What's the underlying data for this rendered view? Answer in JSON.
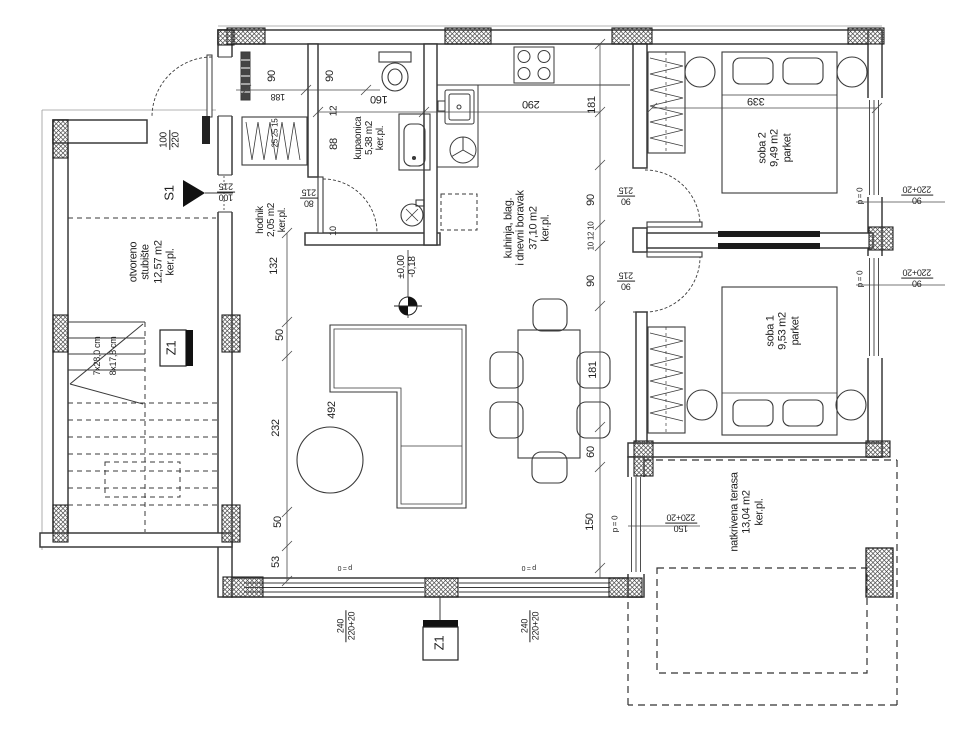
{
  "palette": {
    "line": "#3a3a3a",
    "wall_fill": "#ffffff",
    "hatch": "#4a4a4a",
    "solid_black": "#1c1c1c",
    "text": "#1f1f1f",
    "bg": "#ffffff"
  },
  "rooms_summary": [
    {
      "name": "otvoreno stubište",
      "area": "12,57 m2",
      "floor": "ker.pl."
    },
    {
      "name": "hodnik",
      "area": "2,05 m2",
      "floor": "ker.pl."
    },
    {
      "name": "kupaonica",
      "area": "5,38 m2",
      "floor": "ker.pl."
    },
    {
      "name": "kuhinja, blag. i dnevni boravak",
      "area": "37,10 m2",
      "floor": "ker.pl."
    },
    {
      "name": "soba 1",
      "area": "9,53 m2",
      "floor": "parket"
    },
    {
      "name": "soba 2",
      "area": "9,49 m2",
      "floor": "parket"
    },
    {
      "name": "natkrivena terasa",
      "area": "13,04 m2",
      "floor": "ker.pl."
    }
  ],
  "room_labels": [
    {
      "name": "room-label-stubiste",
      "lines": [
        "otvoreno",
        "stubište",
        "12,57 m2",
        "ker.pl."
      ],
      "x": 152,
      "y": 262,
      "rot": -90,
      "size": 11
    },
    {
      "name": "room-label-hodnik",
      "lines": [
        "hodnik",
        "2,05 m2",
        "ker.pl."
      ],
      "x": 272,
      "y": 220,
      "rot": -90,
      "size": 10
    },
    {
      "name": "room-label-kupaonica",
      "lines": [
        "kupaonica",
        "5,38 m2",
        "ker.pl."
      ],
      "x": 370,
      "y": 138,
      "rot": -90,
      "size": 10
    },
    {
      "name": "room-label-kuhinja",
      "lines": [
        "kuhinja, blag.",
        "i dnevni boravak",
        "37,10 m2",
        "ker.pl."
      ],
      "x": 527,
      "y": 228,
      "rot": -90,
      "size": 11
    },
    {
      "name": "room-label-soba2",
      "lines": [
        "soba 2",
        "9,49 m2",
        "parket"
      ],
      "x": 775,
      "y": 148,
      "rot": -90,
      "size": 11
    },
    {
      "name": "room-label-soba1",
      "lines": [
        "soba 1",
        "9,53 m2",
        "parket"
      ],
      "x": 783,
      "y": 331,
      "rot": -90,
      "size": 11
    },
    {
      "name": "room-label-terasa",
      "lines": [
        "natkrivena terasa",
        "13,04 m2",
        "ker.pl."
      ],
      "x": 747,
      "y": 512,
      "rot": -90,
      "size": 11
    }
  ],
  "dimension_labels": [
    {
      "name": "dim-90-closet-a",
      "lines": [
        "90"
      ],
      "x": 272,
      "y": 76,
      "rot": -90,
      "size": 11
    },
    {
      "name": "dim-90-closet-b",
      "lines": [
        "90"
      ],
      "x": 330,
      "y": 76,
      "rot": -90,
      "size": 11
    },
    {
      "name": "dim-188",
      "lines": [
        "188"
      ],
      "x": 278,
      "y": 97,
      "rot": 180,
      "size": 9
    },
    {
      "name": "dim-25-25-15",
      "lines": [
        "25 25 15"
      ],
      "x": 276,
      "y": 133,
      "rot": -90,
      "size": 8
    },
    {
      "name": "dim-160",
      "lines": [
        "160"
      ],
      "x": 379,
      "y": 99,
      "rot": 180,
      "size": 11
    },
    {
      "name": "dim-290",
      "lines": [
        "290"
      ],
      "x": 531,
      "y": 104,
      "rot": 180,
      "size": 11
    },
    {
      "name": "dim-12",
      "lines": [
        "12"
      ],
      "x": 334,
      "y": 111,
      "rot": -90,
      "size": 10
    },
    {
      "name": "dim-88",
      "lines": [
        "88"
      ],
      "x": 334,
      "y": 144,
      "rot": -90,
      "size": 11
    },
    {
      "name": "dim-10",
      "lines": [
        "10"
      ],
      "x": 333,
      "y": 231,
      "rot": -90,
      "size": 9
    },
    {
      "name": "dim-132",
      "lines": [
        "132"
      ],
      "x": 274,
      "y": 266,
      "rot": -90,
      "size": 11
    },
    {
      "name": "dim-50-a",
      "lines": [
        "50"
      ],
      "x": 280,
      "y": 335,
      "rot": -90,
      "size": 11
    },
    {
      "name": "dim-232",
      "lines": [
        "232"
      ],
      "x": 276,
      "y": 428,
      "rot": -90,
      "size": 11
    },
    {
      "name": "dim-492",
      "lines": [
        "492"
      ],
      "x": 332,
      "y": 410,
      "rot": -90,
      "size": 11
    },
    {
      "name": "dim-50-b",
      "lines": [
        "50"
      ],
      "x": 278,
      "y": 522,
      "rot": -90,
      "size": 11
    },
    {
      "name": "dim-53",
      "lines": [
        "53"
      ],
      "x": 276,
      "y": 562,
      "rot": -90,
      "size": 11
    },
    {
      "name": "stair-spec-risers",
      "lines": [
        "7x28,0 cm"
      ],
      "x": 97,
      "y": 356,
      "rot": -90,
      "size": 9
    },
    {
      "name": "stair-spec-treads",
      "lines": [
        "8x17,8 cm"
      ],
      "x": 113,
      "y": 356,
      "rot": -90,
      "size": 9
    },
    {
      "name": "dim-181-a",
      "lines": [
        "181"
      ],
      "x": 592,
      "y": 105,
      "rot": -90,
      "size": 11
    },
    {
      "name": "dim-90-hall-a",
      "lines": [
        "90"
      ],
      "x": 591,
      "y": 200,
      "rot": -90,
      "size": 11
    },
    {
      "name": "dim-10-12-10",
      "lines": [
        "10 12 10"
      ],
      "x": 592,
      "y": 236,
      "rot": -90,
      "size": 8
    },
    {
      "name": "dim-90-hall-b",
      "lines": [
        "90"
      ],
      "x": 591,
      "y": 281,
      "rot": -90,
      "size": 11
    },
    {
      "name": "dim-181-b",
      "lines": [
        "181"
      ],
      "x": 593,
      "y": 370,
      "rot": -90,
      "size": 11
    },
    {
      "name": "dim-60",
      "lines": [
        "60"
      ],
      "x": 591,
      "y": 452,
      "rot": -90,
      "size": 11
    },
    {
      "name": "dim-150",
      "lines": [
        "150"
      ],
      "x": 590,
      "y": 522,
      "rot": -90,
      "size": 11
    },
    {
      "name": "dim-339",
      "lines": [
        "339"
      ],
      "x": 756,
      "y": 101,
      "rot": 180,
      "size": 11
    }
  ],
  "opening_labels": [
    {
      "name": "door-size-bathroom",
      "lines": [
        "80",
        "215"
      ],
      "x": 309,
      "y": 198,
      "rot": 180,
      "size": 9,
      "frac": true
    },
    {
      "name": "door-size-stairs",
      "lines": [
        "100",
        "215"
      ],
      "x": 226,
      "y": 192,
      "rot": 180,
      "size": 9,
      "frac": true
    },
    {
      "name": "door-size-entrance",
      "lines": [
        "100",
        "220"
      ],
      "x": 170,
      "y": 140,
      "rot": -90,
      "size": 10,
      "frac": true
    },
    {
      "name": "door-size-soba2",
      "lines": [
        "90",
        "215"
      ],
      "x": 626,
      "y": 196,
      "rot": 180,
      "size": 9,
      "frac": true
    },
    {
      "name": "door-size-soba1",
      "lines": [
        "90",
        "215"
      ],
      "x": 626,
      "y": 281,
      "rot": 180,
      "size": 9,
      "frac": true
    },
    {
      "name": "window-size-soba2",
      "lines": [
        "90",
        "220+20"
      ],
      "x": 917,
      "y": 195,
      "rot": 180,
      "size": 9,
      "frac": true
    },
    {
      "name": "window-size-soba1",
      "lines": [
        "90",
        "220+20"
      ],
      "x": 917,
      "y": 278,
      "rot": 180,
      "size": 9,
      "frac": true
    },
    {
      "name": "parapet-soba2",
      "lines": [
        "p = 0"
      ],
      "x": 861,
      "y": 196,
      "rot": -90,
      "size": 8
    },
    {
      "name": "parapet-soba1",
      "lines": [
        "p = 0"
      ],
      "x": 861,
      "y": 279,
      "rot": -90,
      "size": 8
    },
    {
      "name": "window-size-terasa",
      "lines": [
        "150",
        "220+20"
      ],
      "x": 681,
      "y": 523,
      "rot": 180,
      "size": 9,
      "frac": true
    },
    {
      "name": "parapet-terasa",
      "lines": [
        "p = 0"
      ],
      "x": 616,
      "y": 524,
      "rot": -90,
      "size": 8
    },
    {
      "name": "window-size-living-a",
      "lines": [
        "240",
        "220+20"
      ],
      "x": 346,
      "y": 626,
      "rot": -90,
      "size": 9,
      "frac": true
    },
    {
      "name": "window-size-living-b",
      "lines": [
        "240",
        "220+20"
      ],
      "x": 530,
      "y": 626,
      "rot": -90,
      "size": 9,
      "frac": true
    },
    {
      "name": "parapet-living-a",
      "lines": [
        "p = 0"
      ],
      "x": 345,
      "y": 567,
      "rot": 180,
      "size": 7
    },
    {
      "name": "parapet-living-b",
      "lines": [
        "p = 0"
      ],
      "x": 529,
      "y": 567,
      "rot": 180,
      "size": 7
    }
  ],
  "marker_labels": [
    {
      "name": "level-label",
      "lines": [
        "±0,00",
        "-0,18"
      ],
      "x": 407,
      "y": 267,
      "rot": -90,
      "size": 10
    },
    {
      "name": "section-label-s1",
      "lines": [
        "S1"
      ],
      "x": 170,
      "y": 193,
      "rot": -90,
      "size": 13
    },
    {
      "name": "section-label-z1-stair",
      "lines": [
        "Z1"
      ],
      "x": 172,
      "y": 348,
      "rot": -90,
      "size": 13
    },
    {
      "name": "section-label-z1-bottom",
      "lines": [
        "Z1"
      ],
      "x": 440,
      "y": 643,
      "rot": -90,
      "size": 13
    }
  ]
}
